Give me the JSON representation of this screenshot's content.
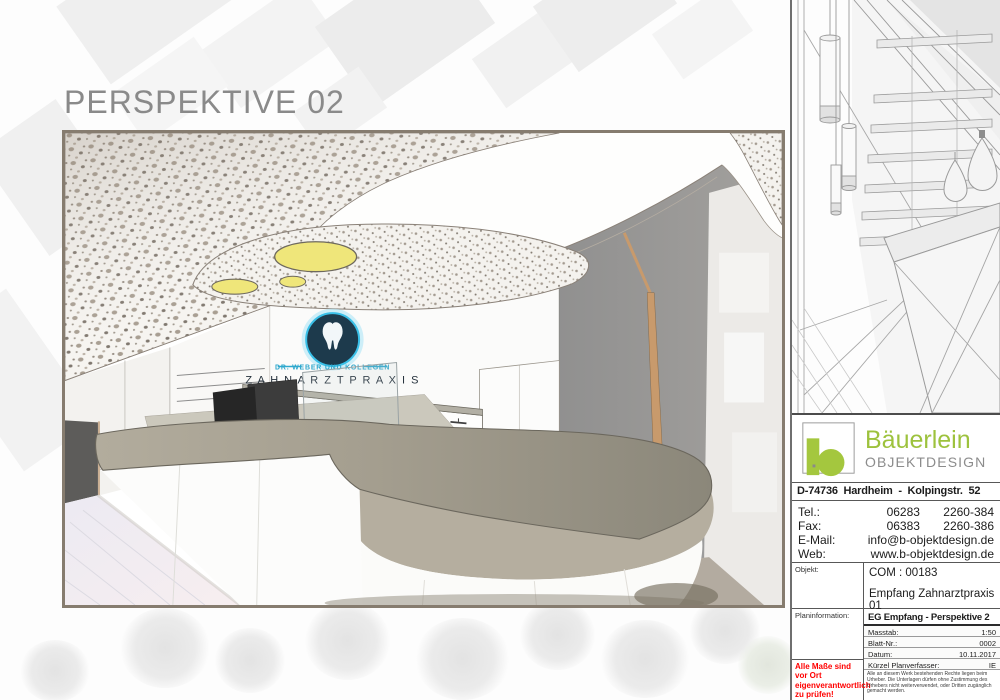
{
  "page": {
    "title": "PERSPEKTIVE 02"
  },
  "render": {
    "brand": {
      "line1": "DR. WEBER UND KOLLEGEN",
      "line2": "Z A H N A R Z T P R A X I S"
    }
  },
  "sidebar": {
    "company": {
      "name": "Bäuerlein",
      "tagline": "OBJEKTDESIGN",
      "address": "D-74736  Hardheim  -  Kolpingstr.  52"
    },
    "contacts": [
      {
        "label": "Tel.:",
        "value": "06283       2260-384"
      },
      {
        "label": "Fax:",
        "value": "06383       2260-386"
      },
      {
        "label": "E-Mail:",
        "value": "info@b-objektdesign.de"
      },
      {
        "label": "Web:",
        "value": "www.b-objektdesign.de"
      }
    ],
    "objekt": {
      "label": "Objekt:",
      "code": "COM : 00183",
      "name": "Empfang Zahnarztpraxis 01"
    },
    "planinfo": {
      "label": "Planinformation:",
      "title": "EG Empfang - Perspektive 2",
      "rows": [
        {
          "label": "Masstab:",
          "value": "1:50"
        },
        {
          "label": "Blatt-Nr.:",
          "value": "0002"
        },
        {
          "label": "Datum:",
          "value": "10.11.2017"
        },
        {
          "label": "Kürzel Planverfasser:",
          "value": "IE"
        }
      ],
      "warning": "Alle Maße sind vor Ort eigenverantwortlich zu prüfen!",
      "copyright": "Alle an diesem Werk bestehenden Rechte liegen beim Urheber. Die Unterlagen dürfen ohne Zustimmung des Urhebers nicht weiterverwendet, oder Dritten zugänglich gemacht werden."
    }
  },
  "colors": {
    "accent_green": "#9dc23d",
    "brand_navy": "#1d3a4c",
    "brand_cyan": "#3ac0e8",
    "warning_red": "#ff0000",
    "counter_taupe": "#a49e8f",
    "ceiling_light_yellow": "#efe67a",
    "frame_border": "#867c6f"
  }
}
